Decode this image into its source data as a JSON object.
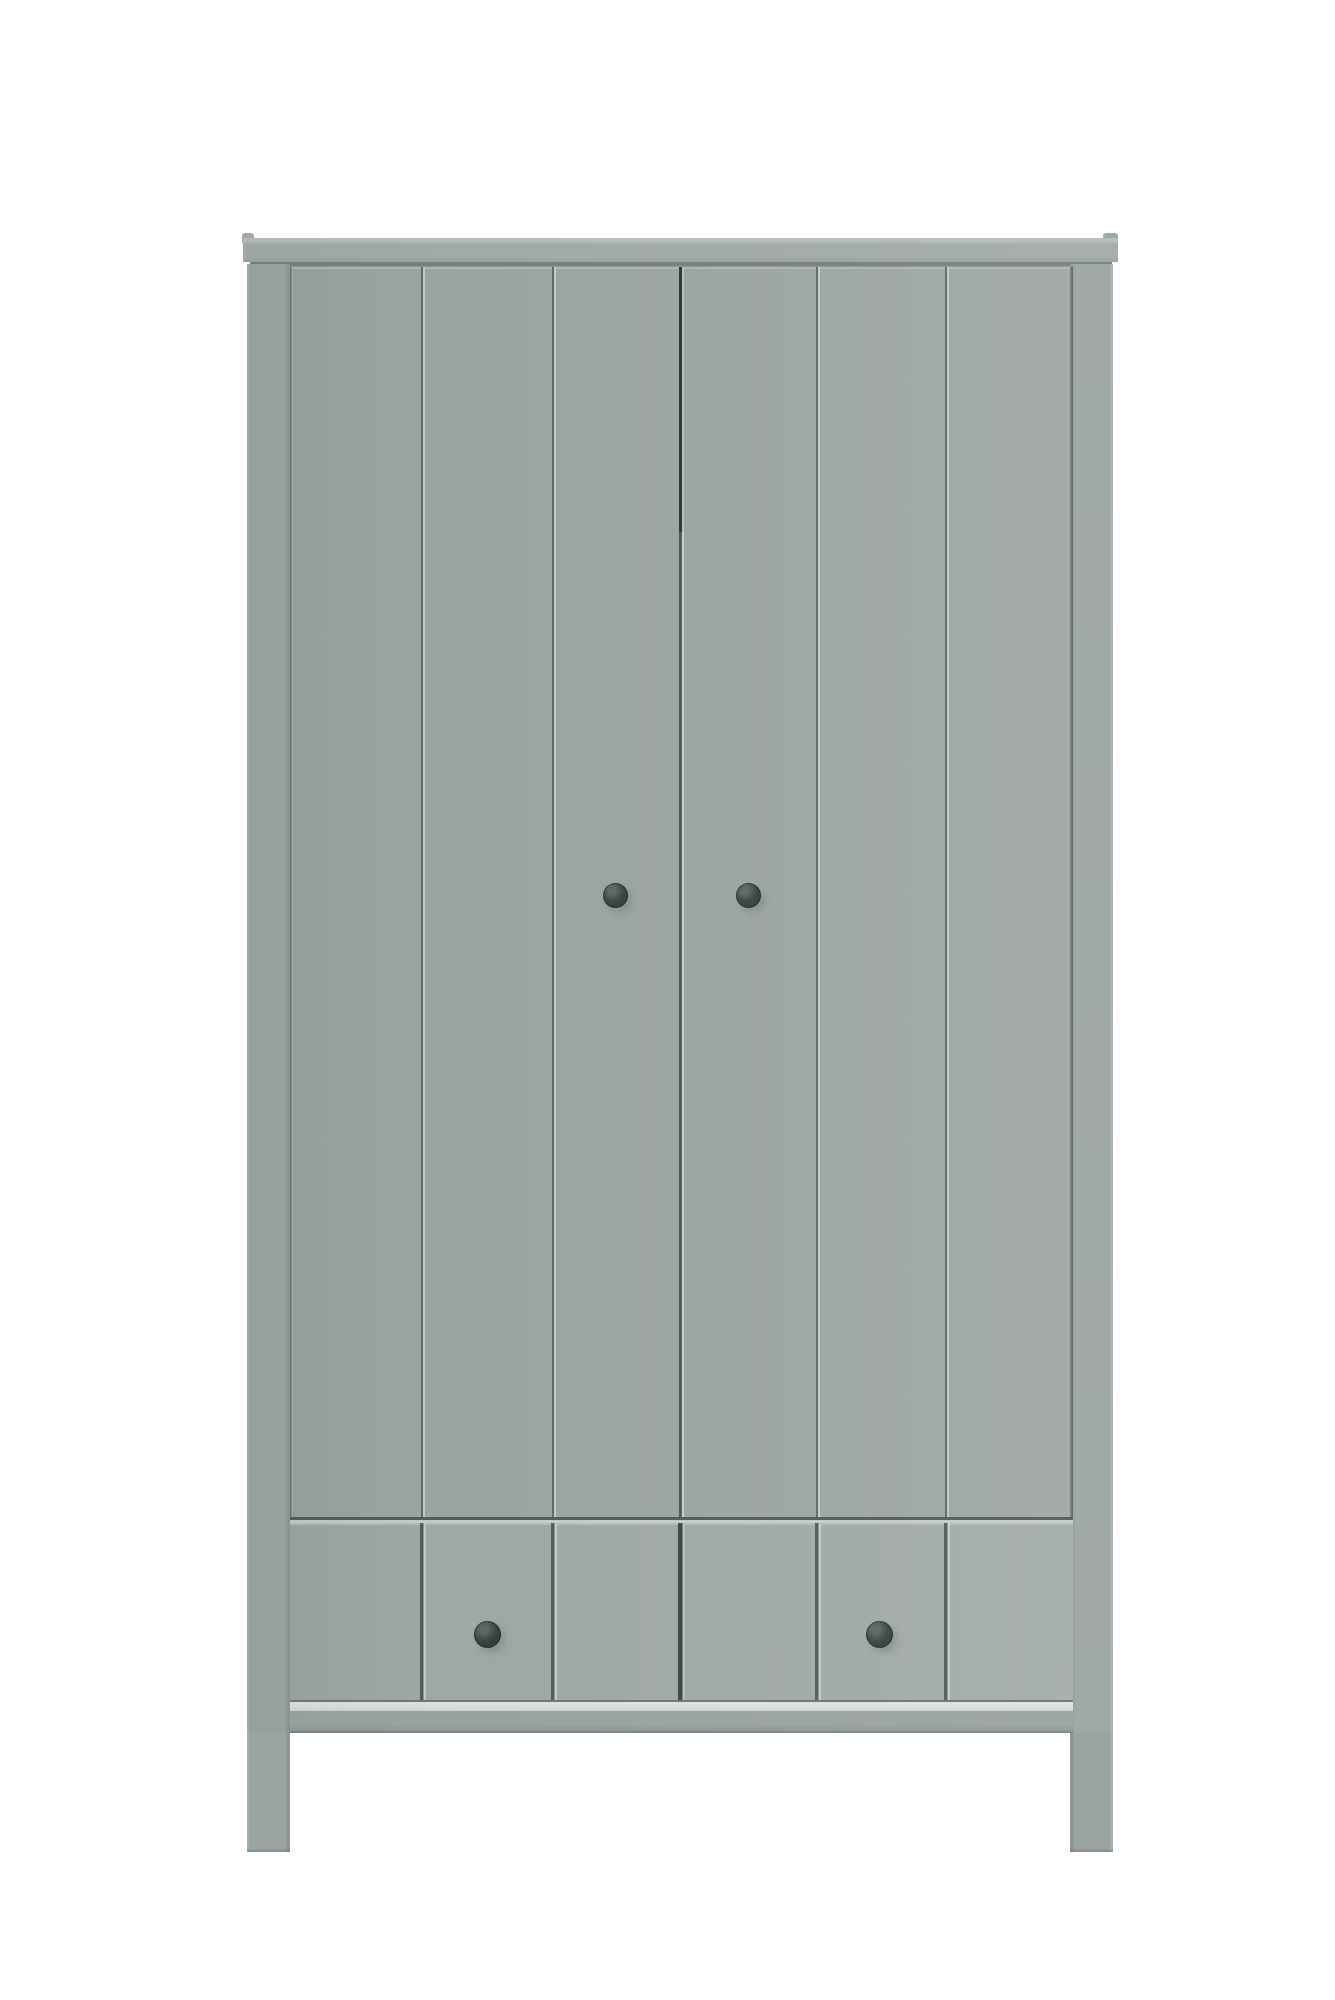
{
  "image": {
    "kind": "furniture product photo",
    "subject": "Grey wardrobe with two vertical-plank doors, two lower drawers and four legs, photographed front-on against a plain white background",
    "text_content": "none"
  },
  "wardrobe": {
    "lid": "overhanging flat top panel",
    "doors": {
      "count": 2,
      "planks_per_door": 3,
      "knobs": 2,
      "knob_shape": "small round dark-grey"
    },
    "drawers": {
      "count": 2,
      "knobs": 2,
      "knob_shape": "small round dark-grey"
    },
    "legs_visible": 2,
    "finish": "matte grey painted wood"
  },
  "colors": {
    "bg": "#ffffff",
    "body": "#9ca4a2",
    "body-light": "#a9b1af",
    "lid-top": "#b6bdbb",
    "lid-face": "#a2aaa8",
    "underlid": "#75807e",
    "groove-dark": "#5e6867",
    "groove-light": "#c3cac8",
    "seam-dark": "#2c3434",
    "hgroove-dark": "#525c5b",
    "drawer-face": "#a0a8a6",
    "bottom-strip": "#ced4d2",
    "rail-top": "#9aa2a0",
    "rail-bottom": "#8e9795",
    "leg-shade": "#8b9593",
    "knob-dark": "#2c3433",
    "knob-mid": "#3c4443",
    "knob-highlight": "#5d6665"
  },
  "geometry": {
    "plank_groove_x": [
      131,
      262,
      526,
      655
    ],
    "door_knobs": [
      {
        "x": 325,
        "y": 631
      },
      {
        "x": 458,
        "y": 631
      }
    ],
    "drawer_knobs": [
      {
        "x": 197,
        "y": 1370
      },
      {
        "x": 589,
        "y": 1370
      }
    ]
  }
}
